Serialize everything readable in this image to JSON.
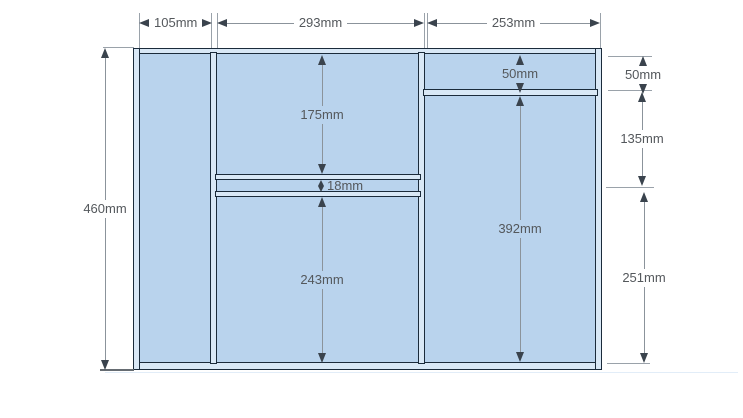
{
  "dims": {
    "top": [
      {
        "label": "105mm"
      },
      {
        "label": "293mm"
      },
      {
        "label": "253mm"
      }
    ],
    "left": [
      {
        "label": "460mm"
      }
    ],
    "right": [
      {
        "label": "50mm"
      },
      {
        "label": "135mm"
      },
      {
        "label": "251mm"
      }
    ],
    "inner": [
      {
        "label": "175mm"
      },
      {
        "label": "18mm"
      },
      {
        "label": "243mm"
      },
      {
        "label": "50mm"
      },
      {
        "label": "392mm"
      }
    ]
  },
  "colors": {
    "panel_fill": "#b9d3ed",
    "wall_edge_light": "#d9e8f6",
    "wall_line_dark": "#1b2b3b",
    "dimension_line": "#8b939b",
    "arrowhead": "#3a434d",
    "label_text": "#54585c",
    "background": "#ffffff"
  }
}
